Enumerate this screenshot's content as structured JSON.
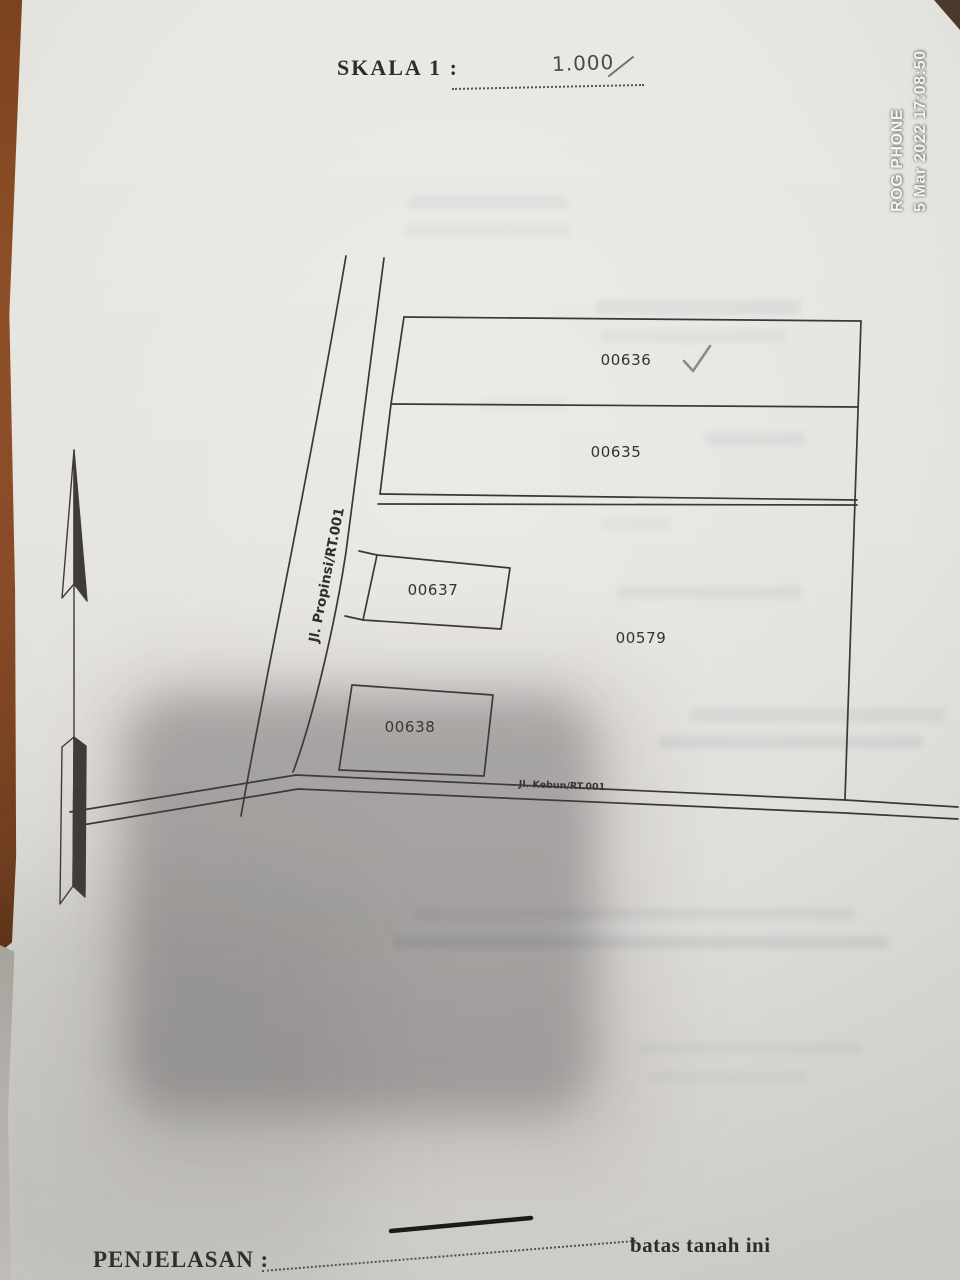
{
  "watermark": {
    "brand": "ROG PHONE",
    "datetime": "5 Mar 2022 17:08:50"
  },
  "document": {
    "scale": {
      "label": "SKALA 1 :",
      "value": "1.000"
    },
    "map": {
      "parcels": {
        "p00636": "00636",
        "p00635": "00635",
        "p00637": "00637",
        "p00638": "00638",
        "p00579": "00579"
      },
      "roads": {
        "propinsi": "Jl. Propinsi/RT.001",
        "kebun": "Jl. Kebun/RT.001"
      },
      "annotations": {
        "checkmark_on": "00636"
      }
    },
    "legend": {
      "heading": "PENJELASAN :",
      "boundary_label": "batas tanah ini"
    }
  },
  "colors": {
    "paper": "#e8e6e1",
    "ink": "#2e2d2b",
    "map_line": "#3a3834",
    "wood_table": "#8a4c28",
    "shadow": "#3e3a3e"
  }
}
